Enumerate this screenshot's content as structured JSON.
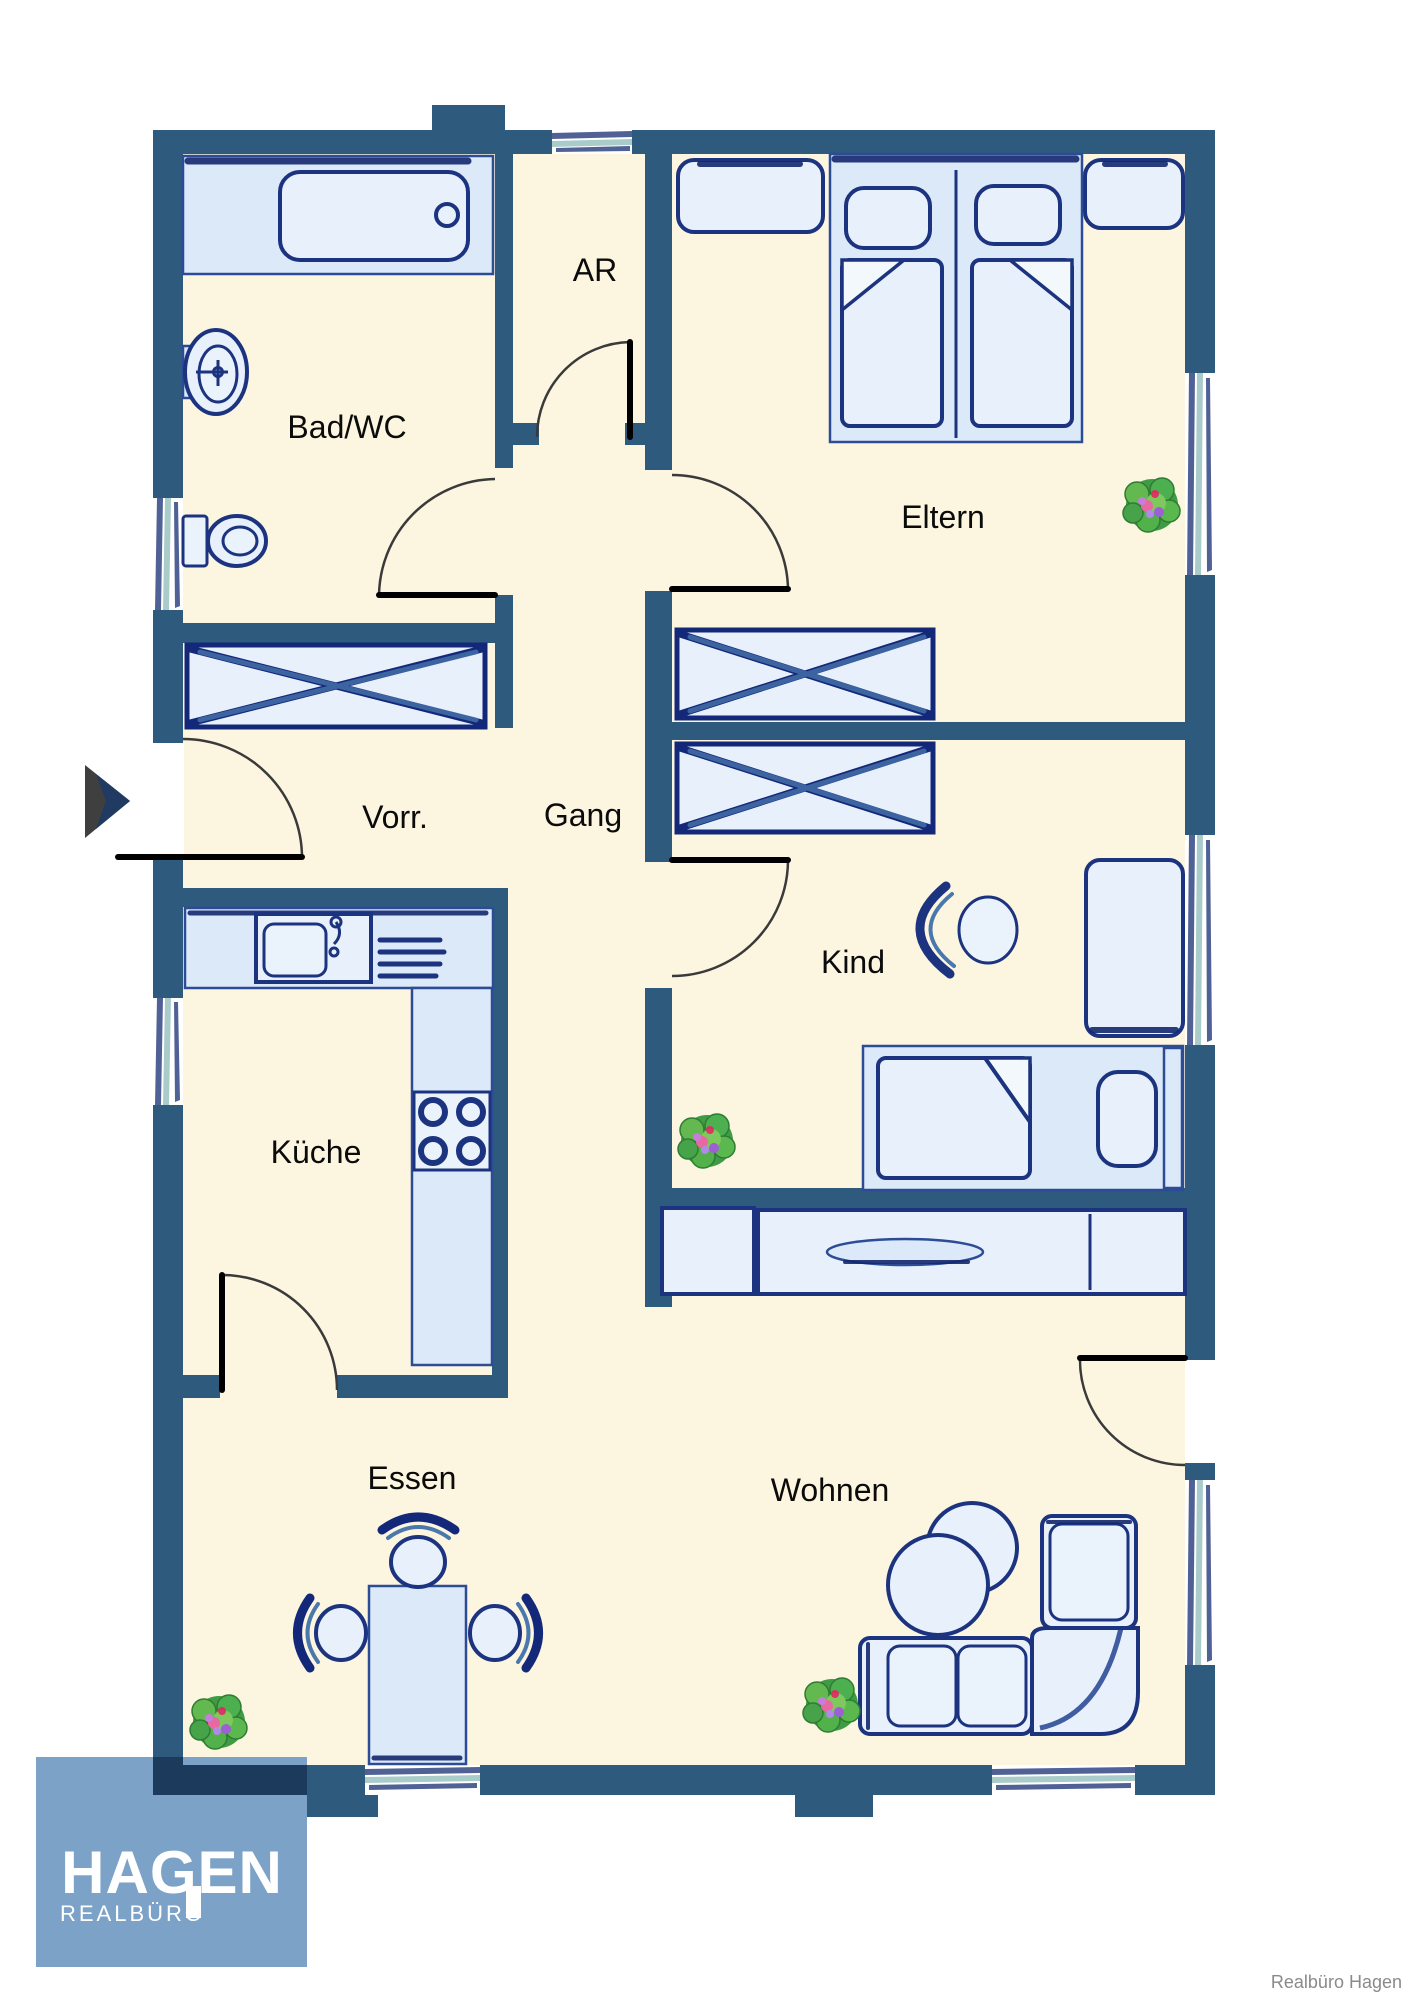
{
  "plan": {
    "type": "apartment-floor-plan",
    "rooms": [
      {
        "id": "bad",
        "label": "Bad/WC"
      },
      {
        "id": "ar",
        "label": "AR"
      },
      {
        "id": "eltern",
        "label": "Eltern"
      },
      {
        "id": "vorr",
        "label": "Vorr."
      },
      {
        "id": "gang",
        "label": "Gang"
      },
      {
        "id": "kind",
        "label": "Kind"
      },
      {
        "id": "kueche",
        "label": "Küche"
      },
      {
        "id": "essen",
        "label": "Essen"
      },
      {
        "id": "wohnen",
        "label": "Wohnen"
      }
    ],
    "colors": {
      "wall": "#2E5A7E",
      "floor": "#FCF5E0",
      "furniture_fill": "#E8F1FB",
      "furniture_fill_alt": "#DCE9F8",
      "outline_dark": "#1C337F",
      "outline_mid": "#4A78AD",
      "window_glazing": "#A9CCCB",
      "plant_green": "#4CAF50",
      "entrance_arrow": "#3F3F3F"
    },
    "furniture_icons": [
      "bathtub-icon",
      "wash-basin-icon",
      "toilet-icon",
      "wardrobe-x-icon",
      "double-bed-icon",
      "nightstand-icon",
      "dresser-icon",
      "desk-icon",
      "desk-chair-icon",
      "single-bed-icon",
      "sideboard-icon",
      "kitchen-counter-icon",
      "kitchen-sink-icon",
      "stove-icon",
      "dining-table-icon",
      "dining-chair-icon",
      "coffee-table-icon",
      "corner-sofa-icon",
      "plant-icon",
      "entrance-arrow-icon"
    ],
    "counts": {
      "windows": 8,
      "doors": 7,
      "plants": 4
    }
  },
  "branding": {
    "logo_title": "HAGEN",
    "logo_subtitle": "REALBÜRO",
    "logo_bg": "#7CA3C7",
    "attribution": "Realbüro Hagen"
  }
}
